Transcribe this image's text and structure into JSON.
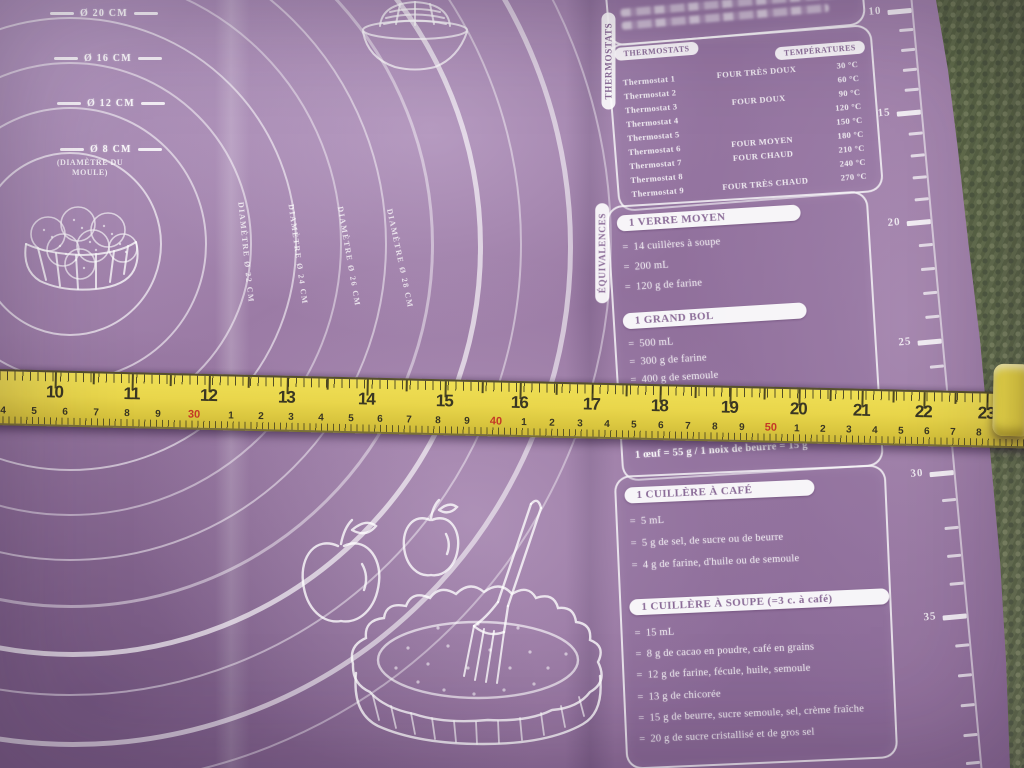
{
  "colors": {
    "mat-purple": "#9a79a6",
    "tape-yellow": "#e9d64b",
    "tape-number": "#3a3723",
    "tape-red": "#c43a26",
    "carpet-green": "#68744f",
    "pill-text": "#8a6b97",
    "line-white": "#ffffff"
  },
  "mat": {
    "circles": [
      {
        "left": -22,
        "top": 152,
        "d": 180,
        "w": 2,
        "o": 0.8
      },
      {
        "left": -67,
        "top": 107,
        "d": 270,
        "w": 2,
        "o": 0.7
      },
      {
        "left": -112,
        "top": 62,
        "d": 360,
        "w": 2,
        "o": 0.65
      },
      {
        "left": -157,
        "top": 17,
        "d": 450,
        "w": 2.5,
        "o": 0.7
      },
      {
        "left": -202,
        "top": -28,
        "d": 540,
        "w": 2,
        "o": 0.55
      },
      {
        "left": -247,
        "top": -73,
        "d": 630,
        "w": 2.5,
        "o": 0.6
      },
      {
        "left": -292,
        "top": -118,
        "d": 720,
        "w": 3,
        "o": 0.55
      },
      {
        "left": -337,
        "top": -163,
        "d": 810,
        "w": 5,
        "o": 0.8
      },
      {
        "left": -382,
        "top": -208,
        "d": 900,
        "w": 2.5,
        "o": 0.55
      },
      {
        "left": -427,
        "top": -253,
        "d": 990,
        "w": 5,
        "o": 0.7
      },
      {
        "left": -472,
        "top": -298,
        "d": 1080,
        "w": 2,
        "o": 0.5
      }
    ],
    "circle_labels": [
      {
        "text": "Ø 20 CM",
        "x": 50,
        "y": 8
      },
      {
        "text": "Ø 16 CM",
        "x": 54,
        "y": 53
      },
      {
        "text": "Ø 12 CM",
        "x": 57,
        "y": 98
      },
      {
        "text": "Ø 8 CM",
        "x": 60,
        "y": 144
      }
    ],
    "mould_note": "(DIAMÈTRE DU MOULE)",
    "rotated_labels": [
      {
        "text": "DIAMÈTRE Ø 22 CM",
        "x": 176,
        "y": 248,
        "a": 84
      },
      {
        "text": "DIAMÈTRE Ø 24 CM",
        "x": 228,
        "y": 250,
        "a": 82
      },
      {
        "text": "DIAMÈTRE Ø 26 CM",
        "x": 279,
        "y": 252,
        "a": 80
      },
      {
        "text": "DIAMÈTRE Ø 28 CM",
        "x": 330,
        "y": 254,
        "a": 78
      }
    ],
    "thermostats": {
      "tab": "THERMOSTATS",
      "header_left": "THERMOSTATS",
      "header_right": "TEMPÉRATURES",
      "rows": [
        {
          "t": "Thermostat 1",
          "four": "FOUR TRÈS DOUX",
          "temp": "30 °C"
        },
        {
          "t": "Thermostat 2",
          "four": "",
          "temp": "60 °C"
        },
        {
          "t": "Thermostat 3",
          "four": "FOUR DOUX",
          "temp": "90 °C"
        },
        {
          "t": "Thermostat 4",
          "four": "",
          "temp": "120 °C"
        },
        {
          "t": "Thermostat 5",
          "four": "",
          "temp": "150 °C"
        },
        {
          "t": "Thermostat 6",
          "four": "FOUR MOYEN",
          "temp": "180 °C"
        },
        {
          "t": "Thermostat 7",
          "four": "FOUR CHAUD",
          "temp": "210 °C"
        },
        {
          "t": "Thermostat 8",
          "four": "",
          "temp": "240 °C"
        },
        {
          "t": "Thermostat 9",
          "four": "FOUR TRÈS CHAUD",
          "temp": "270 °C"
        }
      ]
    },
    "equivalences": {
      "tab": "ÉQUIVALENCES",
      "bullet_marker": "=",
      "verre_moyen": {
        "title": "1 VERRE MOYEN",
        "items": [
          "14 cuillères à soupe",
          "200 mL",
          "120 g de farine"
        ]
      },
      "grand_bol": {
        "title": "1 GRAND BOL",
        "items": [
          "500 mL",
          "300 g de farine",
          "400 g de semoule"
        ]
      },
      "egg_note": "1 œuf = 55 g / 1 noix de beurre = 15 g",
      "cuillere_cafe": {
        "title": "1 CUILLÈRE À CAFÉ",
        "items": [
          "5 mL",
          "5 g de sel, de sucre ou de beurre",
          "4 g de farine, d'huile ou de semoule"
        ]
      },
      "cuillere_soupe": {
        "title": "1 CUILLÈRE À SOUPE (=3 c. à café)",
        "items": [
          "15 mL",
          "8 g de cacao en poudre, café en grains",
          "12 g de farine, fécule, huile, semoule",
          "13 g de chicorée",
          "15 g de beurre, sucre semoule, sel, crème fraîche",
          "20 g de sucre cristallisé et de gros sel"
        ]
      }
    },
    "ruler_ticks": [
      {
        "y": 14,
        "n": "10"
      },
      {
        "y": 34
      },
      {
        "y": 54
      },
      {
        "y": 74
      },
      {
        "y": 94
      },
      {
        "y": 116,
        "n": "15"
      },
      {
        "y": 138
      },
      {
        "y": 160
      },
      {
        "y": 182
      },
      {
        "y": 204
      },
      {
        "y": 226,
        "n": "20"
      },
      {
        "y": 250
      },
      {
        "y": 274
      },
      {
        "y": 298
      },
      {
        "y": 322
      },
      {
        "y": 346,
        "n": "25"
      },
      {
        "y": 372
      },
      {
        "y": 398
      },
      {
        "y": 424
      },
      {
        "y": 450
      },
      {
        "y": 478,
        "n": "30"
      },
      {
        "y": 506
      },
      {
        "y": 534
      },
      {
        "y": 562
      },
      {
        "y": 590
      },
      {
        "y": 622,
        "n": "35"
      },
      {
        "y": 652
      },
      {
        "y": 682
      },
      {
        "y": 712
      },
      {
        "y": 742
      },
      {
        "y": 770
      }
    ]
  },
  "tape": {
    "cm_numbers": [
      {
        "t": "10",
        "x": 63
      },
      {
        "t": "11",
        "x": 140
      },
      {
        "t": "12",
        "x": 217
      },
      {
        "t": "13",
        "x": 295
      },
      {
        "t": "14",
        "x": 375
      },
      {
        "t": "15",
        "x": 453
      },
      {
        "t": "16",
        "x": 528
      },
      {
        "t": "17",
        "x": 600
      },
      {
        "t": "18",
        "x": 668
      },
      {
        "t": "19",
        "x": 738
      },
      {
        "t": "20",
        "x": 807
      },
      {
        "t": "21",
        "x": 870
      },
      {
        "t": "22",
        "x": 932
      },
      {
        "t": "23",
        "x": 995
      }
    ],
    "ticks": [
      {
        "x": 63,
        "h": 16
      },
      {
        "x": 101,
        "h": 11
      },
      {
        "x": 140,
        "h": 16
      },
      {
        "x": 178,
        "h": 11
      },
      {
        "x": 217,
        "h": 16
      },
      {
        "x": 256,
        "h": 11
      },
      {
        "x": 295,
        "h": 16
      },
      {
        "x": 335,
        "h": 11
      },
      {
        "x": 375,
        "h": 16
      },
      {
        "x": 414,
        "h": 11
      },
      {
        "x": 453,
        "h": 16
      },
      {
        "x": 490,
        "h": 11
      },
      {
        "x": 528,
        "h": 16
      },
      {
        "x": 564,
        "h": 11
      },
      {
        "x": 600,
        "h": 16
      },
      {
        "x": 634,
        "h": 11
      },
      {
        "x": 668,
        "h": 16
      },
      {
        "x": 703,
        "h": 11
      },
      {
        "x": 738,
        "h": 16
      },
      {
        "x": 772,
        "h": 11
      },
      {
        "x": 807,
        "h": 16
      },
      {
        "x": 838,
        "h": 11
      },
      {
        "x": 870,
        "h": 16
      },
      {
        "x": 901,
        "h": 11
      },
      {
        "x": 932,
        "h": 16
      },
      {
        "x": 963,
        "h": 11
      },
      {
        "x": 995,
        "h": 16
      }
    ],
    "bottom_numbers": [
      {
        "t": "4",
        "x": 12
      },
      {
        "t": "5",
        "x": 43
      },
      {
        "t": "6",
        "x": 74
      },
      {
        "t": "7",
        "x": 105
      },
      {
        "t": "8",
        "x": 136
      },
      {
        "t": "9",
        "x": 167
      },
      {
        "t": "30",
        "x": 203,
        "red": true
      },
      {
        "t": "1",
        "x": 240
      },
      {
        "t": "2",
        "x": 270
      },
      {
        "t": "3",
        "x": 300
      },
      {
        "t": "4",
        "x": 330
      },
      {
        "t": "5",
        "x": 360
      },
      {
        "t": "6",
        "x": 389
      },
      {
        "t": "7",
        "x": 418
      },
      {
        "t": "8",
        "x": 447
      },
      {
        "t": "9",
        "x": 476
      },
      {
        "t": "40",
        "x": 505,
        "red": true
      },
      {
        "t": "1",
        "x": 533
      },
      {
        "t": "2",
        "x": 561
      },
      {
        "t": "3",
        "x": 589
      },
      {
        "t": "4",
        "x": 616
      },
      {
        "t": "5",
        "x": 643
      },
      {
        "t": "6",
        "x": 670
      },
      {
        "t": "7",
        "x": 697
      },
      {
        "t": "8",
        "x": 724
      },
      {
        "t": "9",
        "x": 751
      },
      {
        "t": "50",
        "x": 780,
        "red": true
      },
      {
        "t": "1",
        "x": 806
      },
      {
        "t": "2",
        "x": 832
      },
      {
        "t": "3",
        "x": 858
      },
      {
        "t": "4",
        "x": 884
      },
      {
        "t": "5",
        "x": 910
      },
      {
        "t": "6",
        "x": 936
      },
      {
        "t": "7",
        "x": 962
      },
      {
        "t": "8",
        "x": 988
      }
    ]
  }
}
